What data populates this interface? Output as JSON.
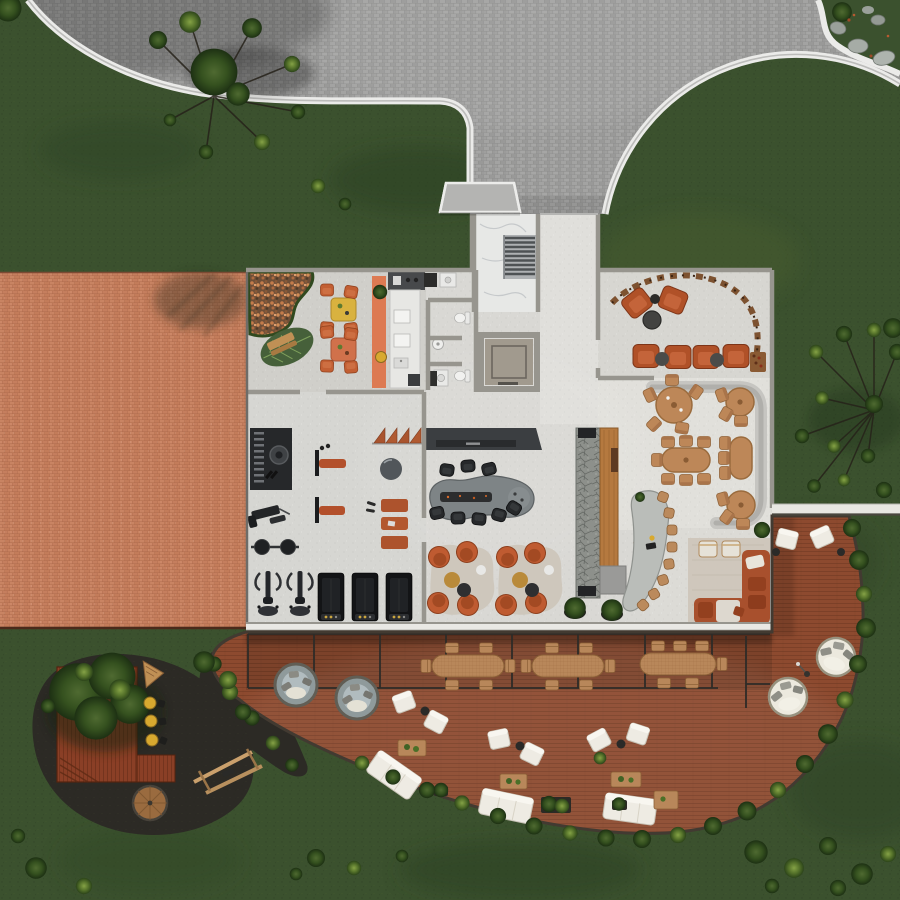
{
  "scene": {
    "title": "Clubhouse amenity level — top-down architectural render",
    "style": "photoreal site plan, no visible text or UI chrome"
  },
  "palette": {
    "grass": "#3b512e",
    "grass-dark": "#2f4426",
    "grass-light": "#4e6535",
    "plaza": "#9c9c9c",
    "curb": "#ebebe9",
    "roof-brick": "#c37c5c",
    "floor": "#d9d8d4",
    "wall": "#97958e",
    "charcoal": "#3b3e41",
    "terracotta": "#bf5b31",
    "sofa-rust": "#a8502d",
    "wood": "#bd8758",
    "deck": "#8d4a2f",
    "stone": "#8d908b",
    "marble": "#e7e8e6",
    "mulch": "#2c2a25",
    "hedge": "#243419",
    "white-furniture": "#eeebe3",
    "equip-black": "#1c1d1f",
    "gold": "#d8a92f",
    "rug": "#cdc6bb",
    "glass": "#a9b4b6"
  },
  "regions": [
    {
      "id": "entry-plaza",
      "label": "Paved entry plaza"
    },
    {
      "id": "circular-lawn",
      "label": "Circular lawn cut into plaza"
    },
    {
      "id": "rock-garden",
      "label": "Corner rock garden"
    },
    {
      "id": "entry-stair-hall",
      "label": "Marble entry stair hall"
    },
    {
      "id": "brick-roof-terrace",
      "label": "Terracotta brick roof"
    },
    {
      "id": "cafe-lounge",
      "label": "Cafe lounge with gravel garden"
    },
    {
      "id": "kitchenette",
      "label": "Kitchenette"
    },
    {
      "id": "washrooms",
      "label": "Washrooms"
    },
    {
      "id": "elevator",
      "label": "Elevator"
    },
    {
      "id": "wine-lounge",
      "label": "Wine lounge with display arc"
    },
    {
      "id": "dining-area",
      "label": "Dining area with curved banquette"
    },
    {
      "id": "chefs-table",
      "label": "Chef's table with stone slab"
    },
    {
      "id": "feature-bar",
      "label": "Stone feature wall, wood bar, curved counter"
    },
    {
      "id": "gym",
      "label": "Fitness room"
    },
    {
      "id": "lounge-pods",
      "label": "Swivel-chair lounge pods"
    },
    {
      "id": "corner-sofa-lounge",
      "label": "Corner sofa lounge"
    },
    {
      "id": "deck",
      "label": "Curved timber deck"
    },
    {
      "id": "deck-dining",
      "label": "Glazed deck dining strip"
    },
    {
      "id": "sunken-lounges",
      "label": "Round glass sunken lounges"
    },
    {
      "id": "daybeds",
      "label": "Round daybeds"
    },
    {
      "id": "outdoor-lounge",
      "label": "White outdoor lounge groups"
    },
    {
      "id": "play-garden",
      "label": "Gravel play garden"
    },
    {
      "id": "lawn",
      "label": "Surrounding lawn"
    }
  ],
  "inventory": {
    "cafe_tables": 2,
    "cafe_chairs": 8,
    "leaf_rug_bench": 1,
    "wine_lounge_armchairs": 6,
    "wine_lounge_poufs": 2,
    "dining_round_tables": 3,
    "dining_pill_tables": 2,
    "dining_chairs": 18,
    "curved_banquette": 1,
    "chef_table_chairs": 8,
    "bar_stools": 8,
    "gym_treadmills": 3,
    "gym_spin_bikes": 2,
    "gym_benches": 2,
    "gym_wall_rack": 1,
    "gym_barbell": 1,
    "gym_exercise_ball": 1,
    "gym_mats": 3,
    "lounge_pod_chairs": 8,
    "lounge_pod_rugs": 2,
    "corner_sofa": 1,
    "corner_armchairs": 2,
    "deck_long_tables": 3,
    "deck_table_chairs": 15,
    "outdoor_white_armchairs": 8,
    "outdoor_white_sofas": 3,
    "outdoor_coffee_tables": 4,
    "sunken_glass_lounges": 2,
    "round_daybeds": 2,
    "deck_planters": 4,
    "floor_lamp": 1,
    "play_yellow_stools": 3,
    "swing_frame": 1,
    "round_wood_platform": 1
  }
}
